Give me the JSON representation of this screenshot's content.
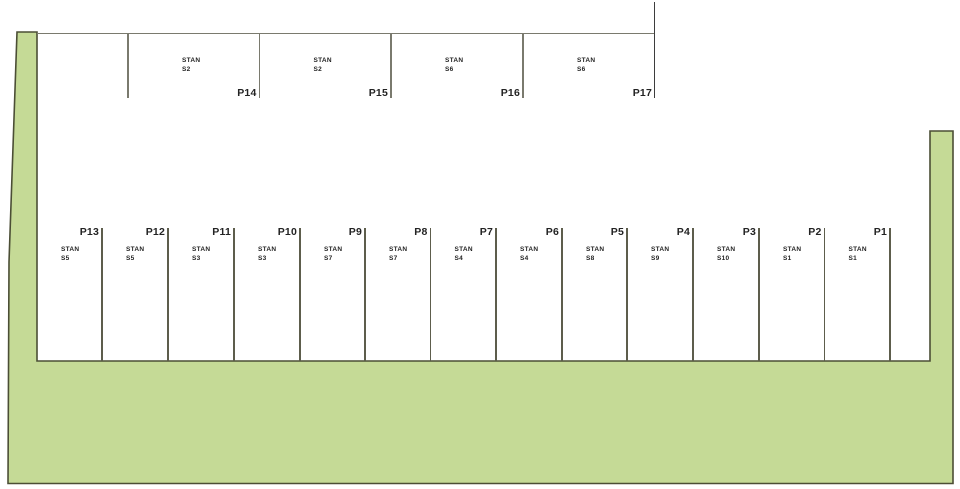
{
  "plan": {
    "canvas": {
      "width": 960,
      "height": 489
    },
    "colors": {
      "background": "#ffffff",
      "land_fill": "#c5da96",
      "land_stroke": "#4b4e35",
      "boundary_line": "#7a7a6e",
      "tall_line": "#3d3d3d",
      "divider_line": "#5d5d4c",
      "label_text": "#232323"
    },
    "land_polygon": "17,32 37,32 37,361 930,361 930,131 953,131 953,483.5 8,483.5 9,262",
    "top_row": {
      "stan_word": "STAN",
      "boundary_y": 33,
      "boundary_x1": 37,
      "boundary_x2": 655,
      "divider_y1": 33,
      "divider_y2": 98,
      "tall_divider_x": 654.5,
      "tall_divider_y1": 2,
      "tall_divider_y2": 98,
      "stan_offset_x": 54,
      "stan_top": 56,
      "label_top": 87,
      "plots": [
        {
          "id": "P14",
          "unit": "S2",
          "left": 128,
          "right": 259.5
        },
        {
          "id": "P15",
          "unit": "S2",
          "left": 259.5,
          "right": 391
        },
        {
          "id": "P16",
          "unit": "S6",
          "left": 391,
          "right": 523
        },
        {
          "id": "P17",
          "unit": "S6",
          "left": 523,
          "right": 655
        }
      ]
    },
    "bottom_row": {
      "stan_word": "STAN",
      "divider_y1": 228,
      "divider_y2": 361,
      "stan_offset_x": 24,
      "stan_top": 245,
      "label_top": 226,
      "plots": [
        {
          "id": "P13",
          "unit": "S5",
          "left": 37,
          "right": 102
        },
        {
          "id": "P12",
          "unit": "S5",
          "left": 102,
          "right": 168
        },
        {
          "id": "P11",
          "unit": "S3",
          "left": 168,
          "right": 234
        },
        {
          "id": "P10",
          "unit": "S3",
          "left": 234,
          "right": 300
        },
        {
          "id": "P9",
          "unit": "S7",
          "left": 300,
          "right": 365
        },
        {
          "id": "P8",
          "unit": "S7",
          "left": 365,
          "right": 430.5
        },
        {
          "id": "P7",
          "unit": "S4",
          "left": 430.5,
          "right": 496
        },
        {
          "id": "P6",
          "unit": "S4",
          "left": 496,
          "right": 562
        },
        {
          "id": "P5",
          "unit": "S8",
          "left": 562,
          "right": 627
        },
        {
          "id": "P4",
          "unit": "S9",
          "left": 627,
          "right": 693
        },
        {
          "id": "P3",
          "unit": "S10",
          "left": 693,
          "right": 759
        },
        {
          "id": "P2",
          "unit": "S1",
          "left": 759,
          "right": 824.5
        },
        {
          "id": "P1",
          "unit": "S1",
          "left": 824.5,
          "right": 890
        }
      ]
    }
  }
}
